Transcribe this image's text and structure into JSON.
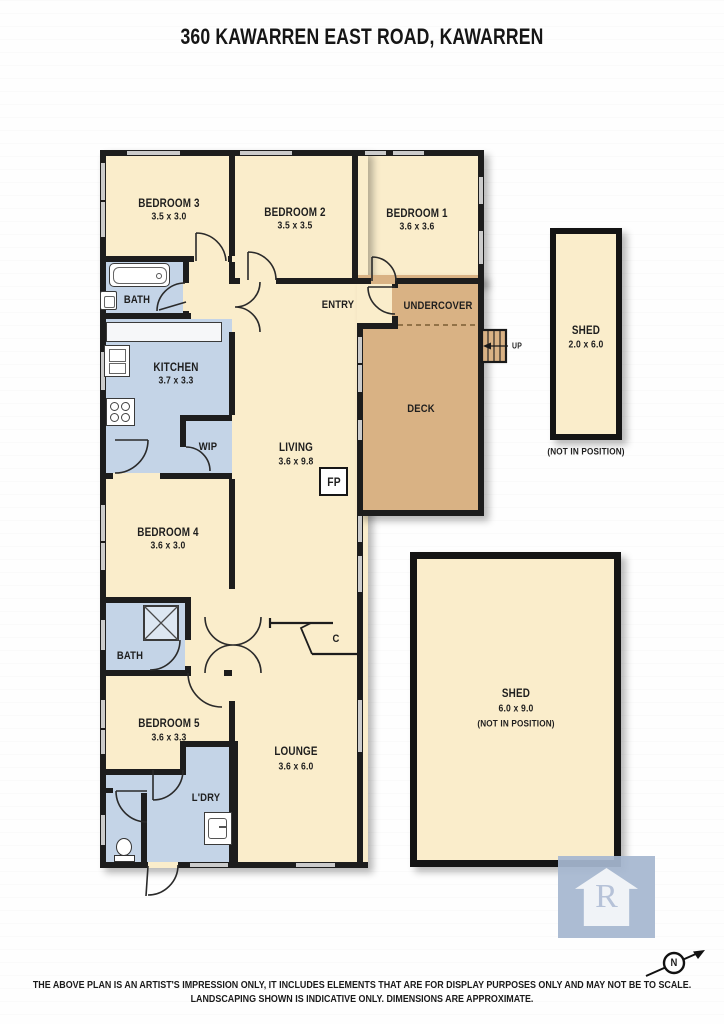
{
  "title": "360 KAWARREN EAST ROAD, KAWARREN",
  "plan": {
    "bedroom3": {
      "name": "BEDROOM 3",
      "dims": "3.5 x 3.0"
    },
    "bedroom2": {
      "name": "BEDROOM 2",
      "dims": "3.5 x 3.5"
    },
    "bedroom1": {
      "name": "BEDROOM 1",
      "dims": "3.6 x 3.6"
    },
    "bedroom4": {
      "name": "BEDROOM 4",
      "dims": "3.6 x 3.0"
    },
    "bedroom5": {
      "name": "BEDROOM 5",
      "dims": "3.6 x 3.3"
    },
    "kitchen": {
      "name": "KITCHEN",
      "dims": "3.7 x 3.3"
    },
    "living": {
      "name": "LIVING",
      "dims": "3.6 x 9.8"
    },
    "lounge": {
      "name": "LOUNGE",
      "dims": "3.6 x 6.0"
    },
    "bath_top": "BATH",
    "bath_mid": "BATH",
    "wip": "WIP",
    "entry": "ENTRY",
    "undercover": "UNDERCOVER",
    "deck": "DECK",
    "fireplace": "FP",
    "closet": "C",
    "laundry": "L'DRY",
    "stairs_up": "UP"
  },
  "sheds": {
    "shed_small": {
      "name": "SHED",
      "dims": "2.0 x 6.0",
      "note": "(NOT IN POSITION)"
    },
    "shed_large": {
      "name": "SHED",
      "dims": "6.0 x 9.0",
      "note": "(NOT IN POSITION)"
    }
  },
  "compass": {
    "north": "N"
  },
  "logo": {
    "letter": "R"
  },
  "disclaimer": {
    "line1": "THE ABOVE PLAN IS AN ARTIST'S IMPRESSION ONLY, IT INCLUDES ELEMENTS THAT ARE FOR DISPLAY PURPOSES ONLY AND MAY NOT BE TO SCALE.",
    "line2": "LANDSCAPING SHOWN IS INDICATIVE ONLY. DIMENSIONS ARE APPROXIMATE."
  },
  "colors": {
    "room_cream": "#faedcb",
    "wet_blue": "#c4d4e7",
    "deck_tan": "#d9b284",
    "wall_black": "#1d1d1d",
    "window_gray": "#cbcbcb",
    "logo_blue": "#a6b7d0"
  }
}
